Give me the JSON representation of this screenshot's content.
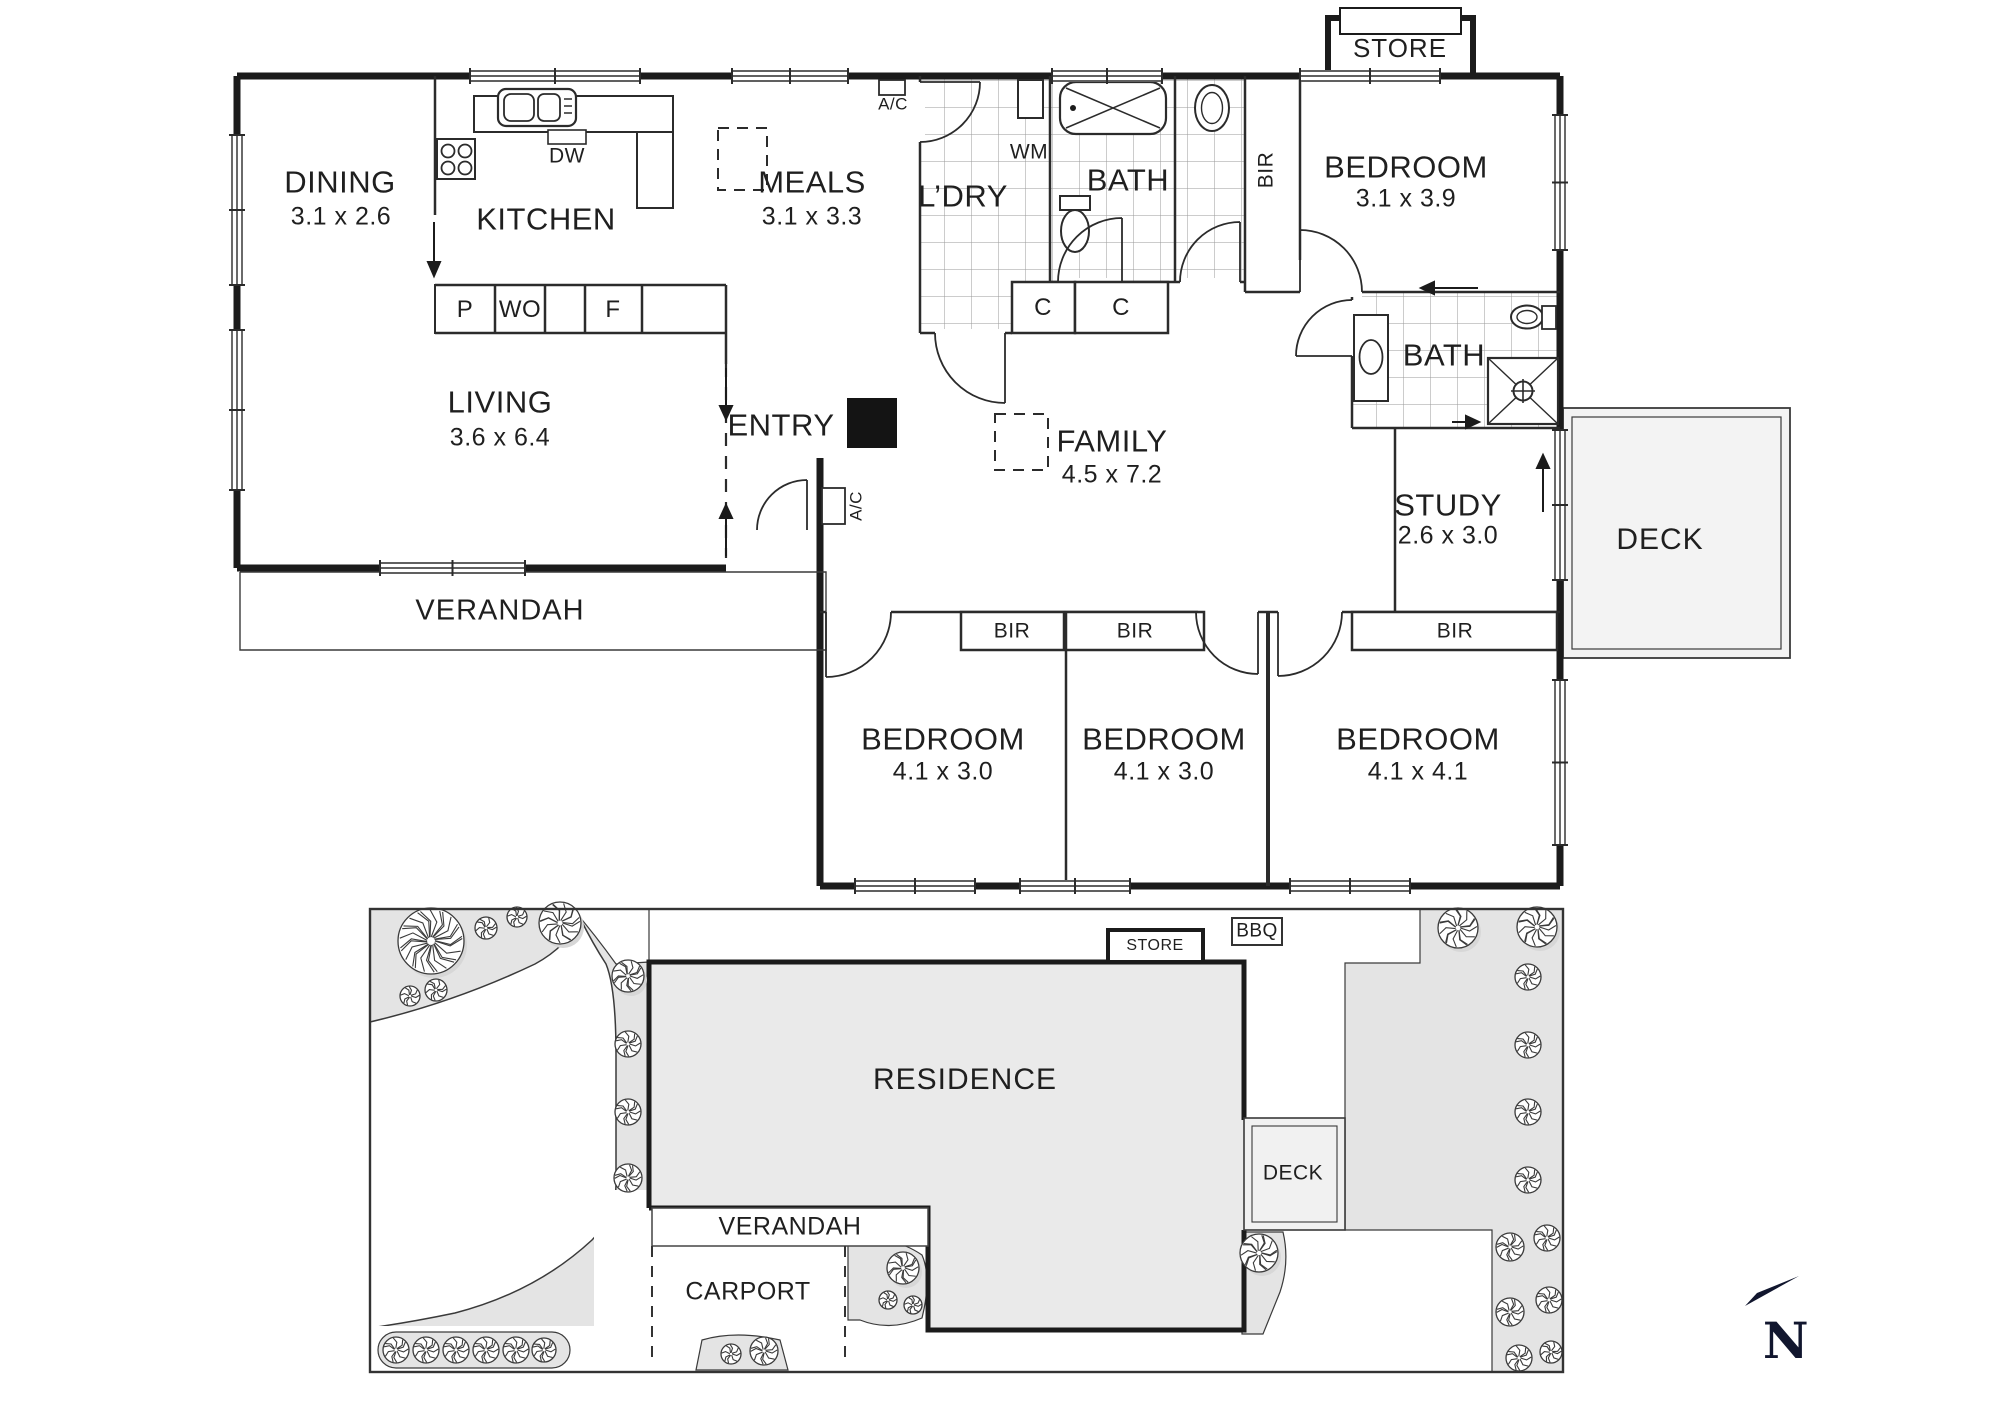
{
  "floor_plan": {
    "rooms": [
      {
        "id": "dining",
        "name": "DINING",
        "dims": "3.1 x 2.6"
      },
      {
        "id": "kitchen",
        "name": "KITCHEN",
        "dims": ""
      },
      {
        "id": "meals",
        "name": "MEALS",
        "dims": "3.1 x 3.3"
      },
      {
        "id": "bedroom-tr",
        "name": "BEDROOM",
        "dims": "3.1 x 3.9"
      },
      {
        "id": "living",
        "name": "LIVING",
        "dims": "3.6 x 6.4"
      },
      {
        "id": "family",
        "name": "FAMILY",
        "dims": "4.5 x 7.2"
      },
      {
        "id": "study",
        "name": "STUDY",
        "dims": "2.6 x 3.0"
      },
      {
        "id": "bedroom-1",
        "name": "BEDROOM",
        "dims": "4.1 x 3.0"
      },
      {
        "id": "bedroom-2",
        "name": "BEDROOM",
        "dims": "4.1 x 3.0"
      },
      {
        "id": "bedroom-3",
        "name": "BEDROOM",
        "dims": "4.1 x 4.1"
      }
    ],
    "labels": {
      "ldry": "L’DRY",
      "bath1": "BATH",
      "bath2": "BATH",
      "entry": "ENTRY",
      "verandah": "VERANDAH",
      "deck": "DECK",
      "store": "STORE",
      "wm": "WM",
      "dw": "DW",
      "p": "P",
      "wo": "WO",
      "f": "F",
      "c1": "C",
      "c2": "C",
      "bir_vert": "BIR",
      "bir1": "BIR",
      "bir2": "BIR",
      "bir3": "BIR",
      "ac_top": "A/C",
      "ac_entry": "A/C"
    }
  },
  "site_plan": {
    "residence": "RESIDENCE",
    "verandah": "VERANDAH",
    "carport": "CARPORT",
    "deck": "DECK",
    "store": "STORE",
    "bbq": "BBQ"
  },
  "compass": {
    "north": "N"
  },
  "colors": {
    "wall": "#1b1b1b",
    "thin_line": "#2b2b2b",
    "tile_line": "#9a9a9a",
    "garden_fill": "#e4e4e4",
    "residence_fill": "#eaeaea",
    "deck_fill": "#f1f1f1",
    "north_arrow": "#11162e"
  }
}
